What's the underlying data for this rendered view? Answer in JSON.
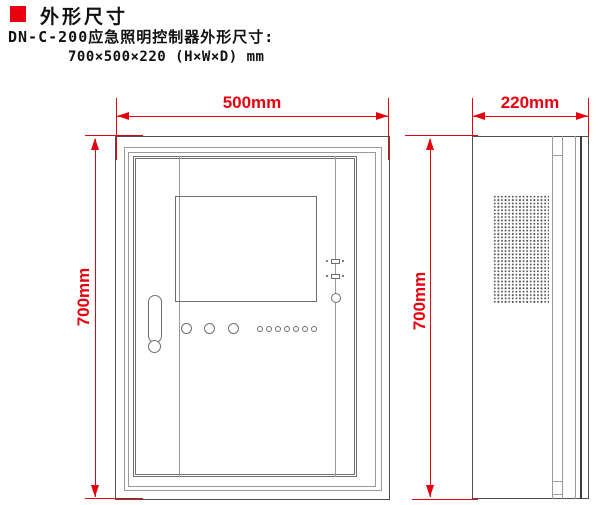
{
  "colors": {
    "accent_red": "#e8000f",
    "line_gray": "#9a9a9a",
    "line_dark": "#4f4f4f",
    "text": "#111111"
  },
  "header": {
    "title": "外形尺寸",
    "subtitle": "DN-C-200应急照明控制器外形尺寸:",
    "size_line": "700×500×220 (H×W×D) mm"
  },
  "front_view": {
    "width_label": "500mm",
    "height_label": "700mm"
  },
  "side_view": {
    "depth_label": "220mm",
    "height_label": "700mm"
  }
}
